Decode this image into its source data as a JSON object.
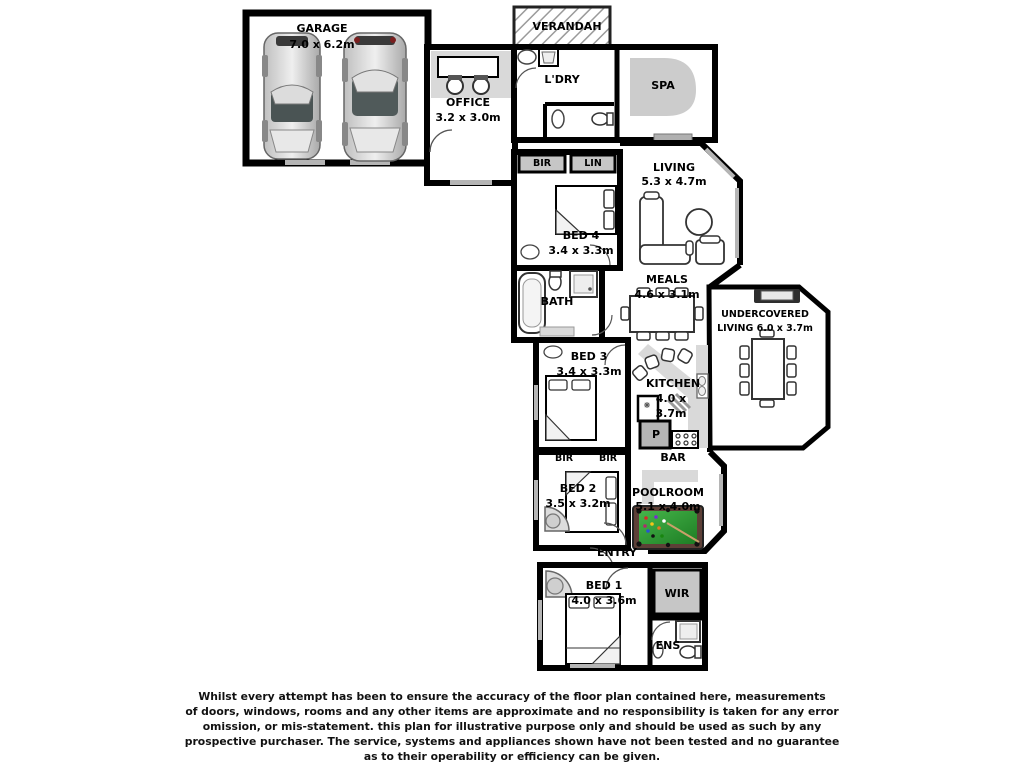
{
  "colors": {
    "wall": "#000000",
    "carpet": "#d9d9d9",
    "robe": "#c6c6c6",
    "felt": "#2f9e35",
    "rail": "#5d4037"
  },
  "rooms": {
    "garage": {
      "name": "GARAGE",
      "dims": "7.0 x 6.2m"
    },
    "office": {
      "name": "OFFICE",
      "dims": "3.2 x 3.0m"
    },
    "verandah": {
      "name": "VERANDAH"
    },
    "ldry": {
      "name": "L'DRY"
    },
    "spa": {
      "name": "SPA"
    },
    "living": {
      "name": "LIVING",
      "dims": "5.3 x 4.7m"
    },
    "bir_top": {
      "name": "BIR"
    },
    "lin": {
      "name": "LIN"
    },
    "bed4": {
      "name": "BED 4",
      "dims": "3.4 x 3.3m"
    },
    "bath": {
      "name": "BATH"
    },
    "meals": {
      "name": "MEALS",
      "dims": "4.6 x 3.1m"
    },
    "undercovered": {
      "line1": "UNDERCOVERED",
      "line2": "LIVING 6.0 x 3.7m"
    },
    "bed3": {
      "name": "BED 3",
      "dims": "3.4 x 3.3m"
    },
    "kitchen": {
      "name": "KITCHEN",
      "dims1": "4.0 x",
      "dims2": "3.7m"
    },
    "pantry": {
      "name": "P"
    },
    "bir_left": {
      "name": "BIR"
    },
    "bir_right": {
      "name": "BIR"
    },
    "bar": {
      "name": "BAR"
    },
    "bed2": {
      "name": "BED 2",
      "dims": "3.5 x 3.2m"
    },
    "poolroom": {
      "name": "POOLROOM",
      "dims": "5.1 x 4.0m"
    },
    "entry": {
      "name": "ENTRY"
    },
    "bed1": {
      "name": "BED 1",
      "dims": "4.0 x 3.6m"
    },
    "wir": {
      "name": "WIR"
    },
    "ens": {
      "name": "ENS"
    }
  },
  "disclaimer": [
    "Whilst every attempt has been to ensure the accuracy of the floor plan contained here, measurements",
    "of doors, windows, rooms and any other items are approximate and no responsibility is taken for any error",
    "omission, or mis-statement. this plan for illustrative purpose only and should be used as such by any",
    "prospective purchaser. The service, systems and appliances shown have not been tested and no guarantee",
    "as to their operability or efficiency can be given."
  ]
}
